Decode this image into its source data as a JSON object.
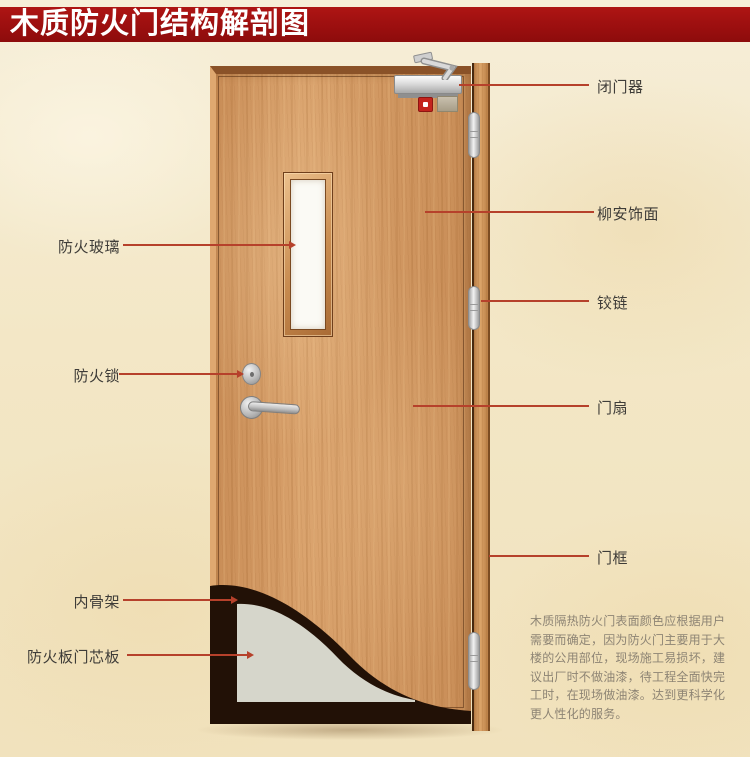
{
  "title": "木质防火门结构解剖图",
  "annotations": {
    "left": [
      {
        "label": "防火玻璃"
      },
      {
        "label": "防火锁"
      },
      {
        "label": "内骨架"
      },
      {
        "label": "防火板门芯板"
      }
    ],
    "right": [
      {
        "label": "闭门器"
      },
      {
        "label": "柳安饰面"
      },
      {
        "label": "铰链"
      },
      {
        "label": "门扇"
      },
      {
        "label": "门框"
      }
    ]
  },
  "description_lines": [
    "木质隔热防火门表面颜色应根据用户",
    "需要而确定，因为防火门主要用于大",
    "楼的公用部位，现场施工易损坏，建",
    "议出厂时不做油漆，待工程全面快完",
    "工时，在现场做油漆。达到更科学化",
    "更人性化的服务。"
  ],
  "colors": {
    "banner_red": "#9c0f0f",
    "annotation_line": "#b6412b",
    "door_wood": "#d49a64",
    "frame_wood": "#cf9357",
    "core_board": "#d6d6cb",
    "inner_skeleton": "#221106",
    "background": "#f3e7c7"
  }
}
